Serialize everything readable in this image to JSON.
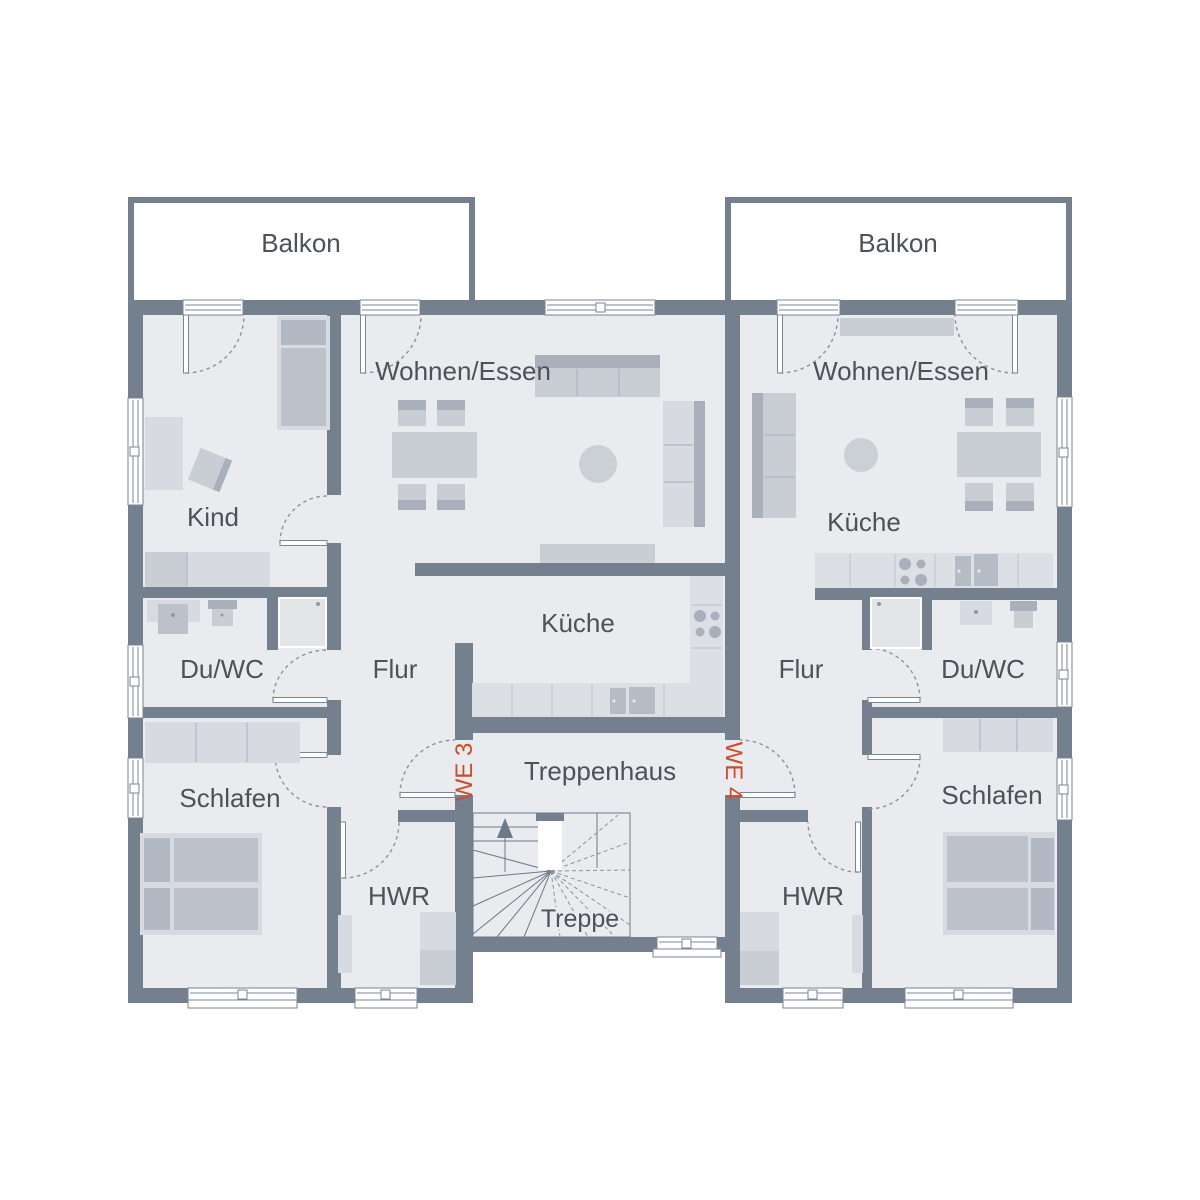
{
  "plan_type": "floor-plan",
  "units": [
    {
      "id": "WE 3",
      "rooms": [
        "Balkon",
        "Wohnen/Essen",
        "Kind",
        "Küche",
        "Du/WC",
        "Flur",
        "Schlafen",
        "HWR"
      ]
    },
    {
      "id": "WE 4",
      "rooms": [
        "Balkon",
        "Wohnen/Essen",
        "Küche",
        "Du/WC",
        "Flur",
        "Schlafen",
        "HWR"
      ]
    }
  ],
  "stairwell": {
    "label": "Treppenhaus",
    "stair_label": "Treppe",
    "stair_direction_icon": "up-arrow"
  },
  "labels": {
    "balcony_left": "Balkon",
    "balcony_right": "Balkon",
    "living_left": "Wohnen/Essen",
    "living_right": "Wohnen/Essen",
    "kids_room": "Kind",
    "kitchen_left": "Küche",
    "kitchen_right": "Küche",
    "bath_left": "Du/WC",
    "bath_right": "Du/WC",
    "hall_left": "Flur",
    "hall_right": "Flur",
    "bedroom_left": "Schlafen",
    "bedroom_right": "Schlafen",
    "utility_left": "HWR",
    "utility_right": "HWR",
    "stairwell": "Treppenhaus",
    "stairs": "Treppe",
    "unit_left": "WE 3",
    "unit_right": "WE 4"
  },
  "colors": {
    "wall": "#75808E",
    "floor": "#E9EBEE",
    "background": "#FFFFFF",
    "room_label_text": "#4C525A",
    "unit_label_text": "#C94F2C",
    "furniture_light": "#D7DAE0",
    "furniture_dark": "#A9B0BC"
  }
}
